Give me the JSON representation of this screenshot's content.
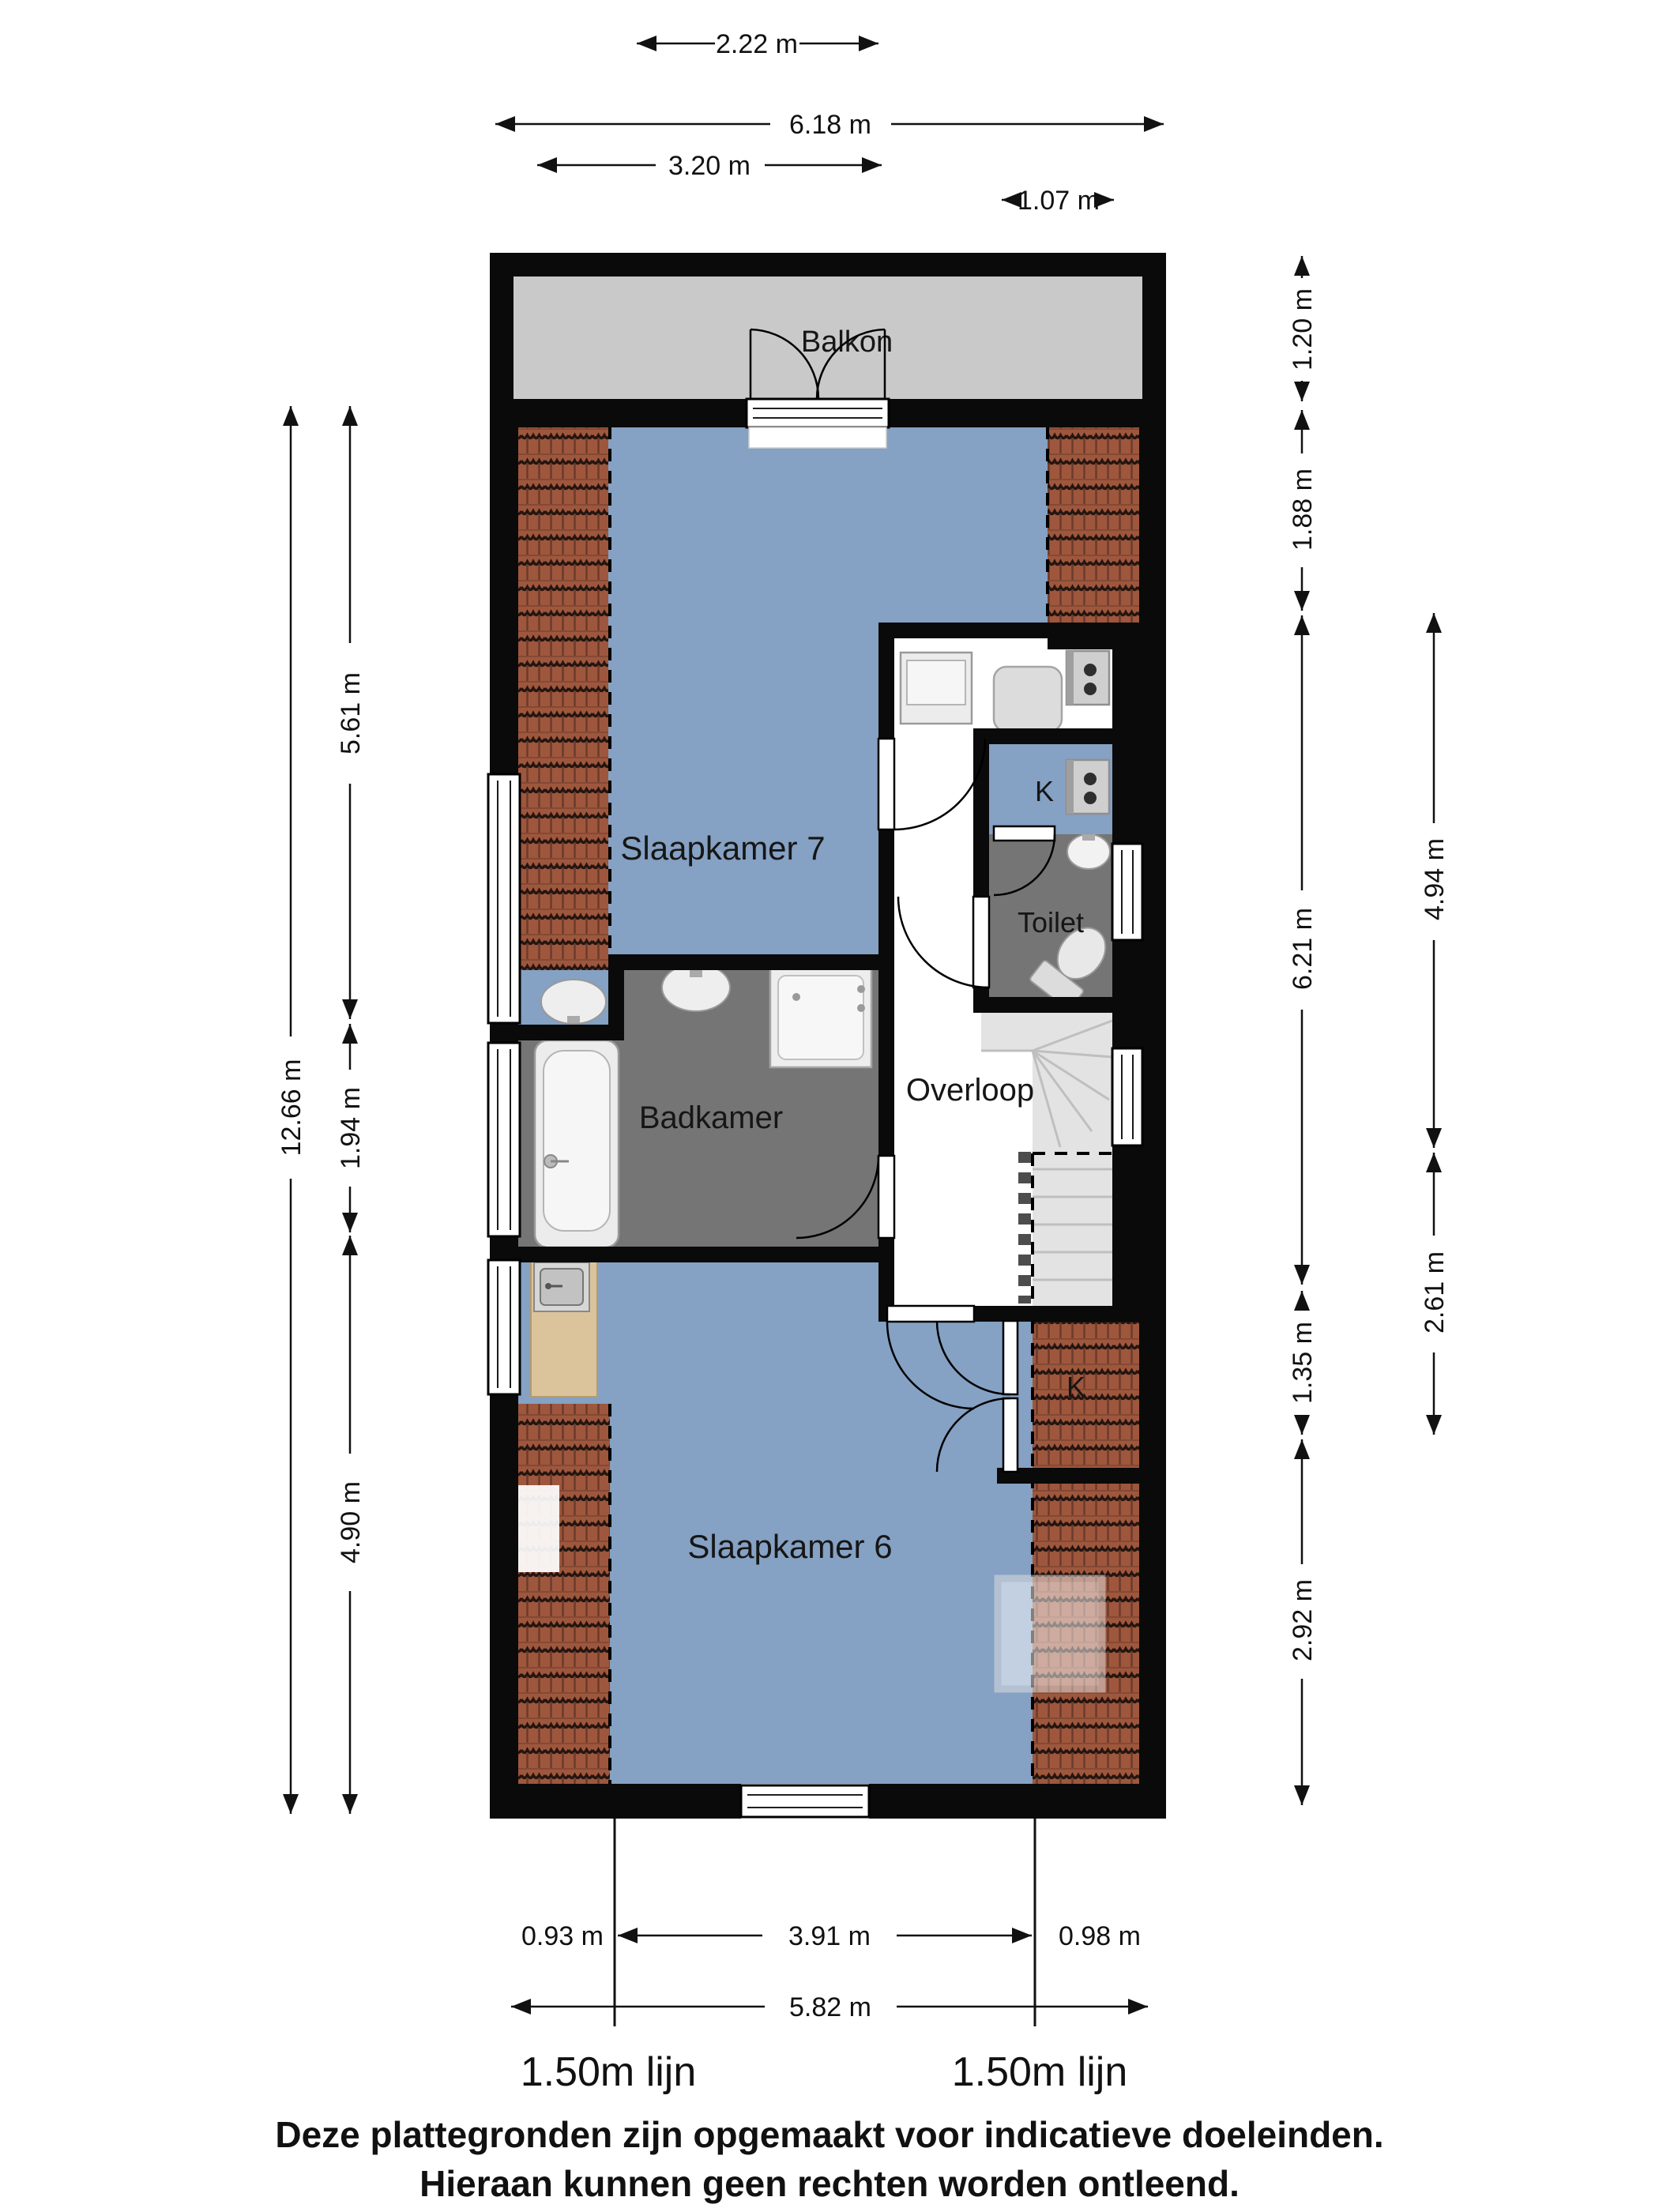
{
  "page": {
    "type": "floorplan",
    "disclaimer_line1": "Deze plattegronden zijn opgemaakt voor indicatieve doeleinden.",
    "disclaimer_line2": "Hieraan kunnen geen rechten worden ontleend."
  },
  "rooms": {
    "balkon": {
      "label": "Balkon"
    },
    "slaapkamer7": {
      "label": "Slaapkamer 7"
    },
    "badkamer": {
      "label": "Badkamer"
    },
    "overloop": {
      "label": "Overloop"
    },
    "toilet": {
      "label": "Toilet"
    },
    "kast_boven": {
      "label": "K"
    },
    "kast_onder": {
      "label": "K"
    },
    "slaapkamer6": {
      "label": "Slaapkamer 6"
    }
  },
  "dimensions": {
    "top": [
      {
        "label": "2.22 m"
      },
      {
        "label": "6.18 m"
      },
      {
        "label": "3.20 m"
      },
      {
        "label": "1.07 m"
      }
    ],
    "left": [
      {
        "label": "12.66 m"
      },
      {
        "label": "5.61 m"
      },
      {
        "label": "1.94 m"
      },
      {
        "label": "4.90 m"
      }
    ],
    "right_inner": [
      {
        "label": "1.20 m"
      },
      {
        "label": "1.88 m"
      },
      {
        "label": "6.21 m"
      },
      {
        "label": "1.35 m"
      },
      {
        "label": "2.92 m"
      }
    ],
    "right_outer": [
      {
        "label": "4.94 m"
      },
      {
        "label": "2.61 m"
      }
    ],
    "bottom": [
      {
        "label": "0.93 m"
      },
      {
        "label": "3.91 m"
      },
      {
        "label": "0.98 m"
      },
      {
        "label": "5.82 m"
      }
    ]
  },
  "height_lines": {
    "left": "1.50m lijn",
    "right": "1.50m lijn"
  },
  "colors": {
    "wall": "#0a0a0a",
    "bedroom": "#85a1c3",
    "bathroom": "#757575",
    "balcony": "#c9c9c9",
    "tiles": "#9e573d",
    "stairs": "#e3e3e3",
    "wood": "#dbc49c"
  }
}
